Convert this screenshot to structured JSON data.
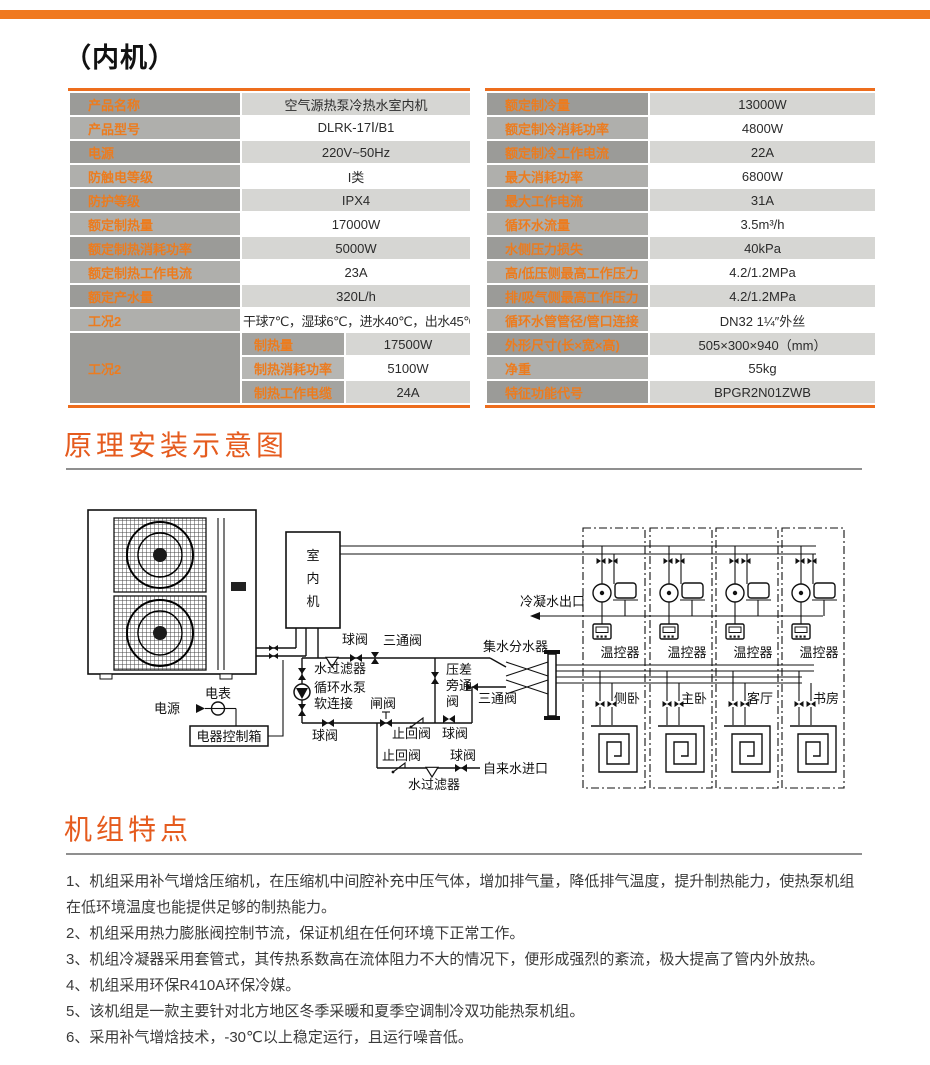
{
  "page": {
    "title": "（内机）"
  },
  "colors": {
    "accent_bar": "#F0791F",
    "table_border": "#ED6D1D",
    "label_orange": "#EC7C1F",
    "heading_orange": "#E55B1E",
    "row_dark": "#9B9B98",
    "row_mid": "#AFAFAC",
    "row_gray": "#D6D6D3"
  },
  "spec": {
    "left": [
      {
        "label": "产品名称",
        "value": "空气源热泵冷热水室内机"
      },
      {
        "label": "产品型号",
        "value": "DLRK-17Ⅰ/B1"
      },
      {
        "label": "电源",
        "value": "220V~50Hz"
      },
      {
        "label": "防触电等级",
        "value": "I类"
      },
      {
        "label": "防护等级",
        "value": "IPX4"
      },
      {
        "label": "额定制热量",
        "value": "17000W"
      },
      {
        "label": "额定制热消耗功率",
        "value": "5000W"
      },
      {
        "label": "额定制热工作电流",
        "value": "23A"
      },
      {
        "label": "额定产水量",
        "value": "320L/h"
      },
      {
        "label": "工况2",
        "value": "干球7℃，湿球6℃，进水40℃，出水45℃"
      }
    ],
    "left_group": {
      "label": "工况2",
      "rows": [
        {
          "label": "制热量",
          "value": "17500W"
        },
        {
          "label": "制热消耗功率",
          "value": "5100W"
        },
        {
          "label": "制热工作电缆",
          "value": "24A"
        }
      ]
    },
    "right": [
      {
        "label": "额定制冷量",
        "value": "13000W"
      },
      {
        "label": "额定制冷消耗功率",
        "value": "4800W"
      },
      {
        "label": "额定制冷工作电流",
        "value": "22A"
      },
      {
        "label": "最大消耗功率",
        "value": "6800W"
      },
      {
        "label": "最大工作电流",
        "value": "31A"
      },
      {
        "label": "循环水流量",
        "value": "3.5m³/h"
      },
      {
        "label": "水侧压力损失",
        "value": "40kPa"
      },
      {
        "label": "高/低压侧最高工作压力",
        "value": "4.2/1.2MPa"
      },
      {
        "label": "排/吸气侧最高工作压力",
        "value": "4.2/1.2MPa"
      },
      {
        "label": "循环水管管径/管口连接",
        "value": "DN32 1¼″外丝"
      },
      {
        "label": "外形尺寸(长×宽×高)",
        "value": "505×300×940（mm）"
      },
      {
        "label": "净重",
        "value": "55kg"
      },
      {
        "label": "特征功能代号",
        "value": "BPGR2N01ZWB"
      }
    ]
  },
  "sections": {
    "diagram_heading": "原理安装示意图",
    "features_heading": "机组特点"
  },
  "features": [
    "1、机组采用补气增焓压缩机，在压缩机中间腔补充中压气体，增加排气量，降低排气温度，提升制热能力，使热泵机组在低环境温度也能提供足够的制热能力。",
    "2、机组采用热力膨胀阀控制节流，保证机组在任何环境下正常工作。",
    "3、机组冷凝器采用套管式，其传热系数高在流体阻力不大的情况下，便形成强烈的紊流，极大提高了管内外放热。",
    "4、机组采用环保R410A环保冷媒。",
    "5、该机组是一款主要针对北方地区冬季采暖和夏季空调制冷双功能热泵机组。",
    "6、采用补气增焓技术，-30℃以上稳定运行，且运行噪音低。"
  ],
  "diagram": {
    "labels": {
      "indoor_unit_lines": [
        "室",
        "内",
        "机"
      ],
      "ball_valve": "球阀",
      "three_way_valve": "三通阀",
      "water_filter": "水过滤器",
      "circulation_pump": "循环水泵",
      "soft_connection": "软连接",
      "electric_meter": "电表",
      "power_supply": "电源",
      "control_box": "电器控制箱",
      "gate_valve": "闸阀",
      "check_valve": "止回阀",
      "bypass_valve_lines": [
        "压差",
        "旁通",
        "阀"
      ],
      "manifold": "集水分水器",
      "condensate_outlet": "冷凝水出口",
      "tap_water_inlet": "自来水进口",
      "thermostat": "温控器",
      "rooms": [
        "侧卧",
        "主卧",
        "客厅",
        "书房"
      ]
    }
  }
}
